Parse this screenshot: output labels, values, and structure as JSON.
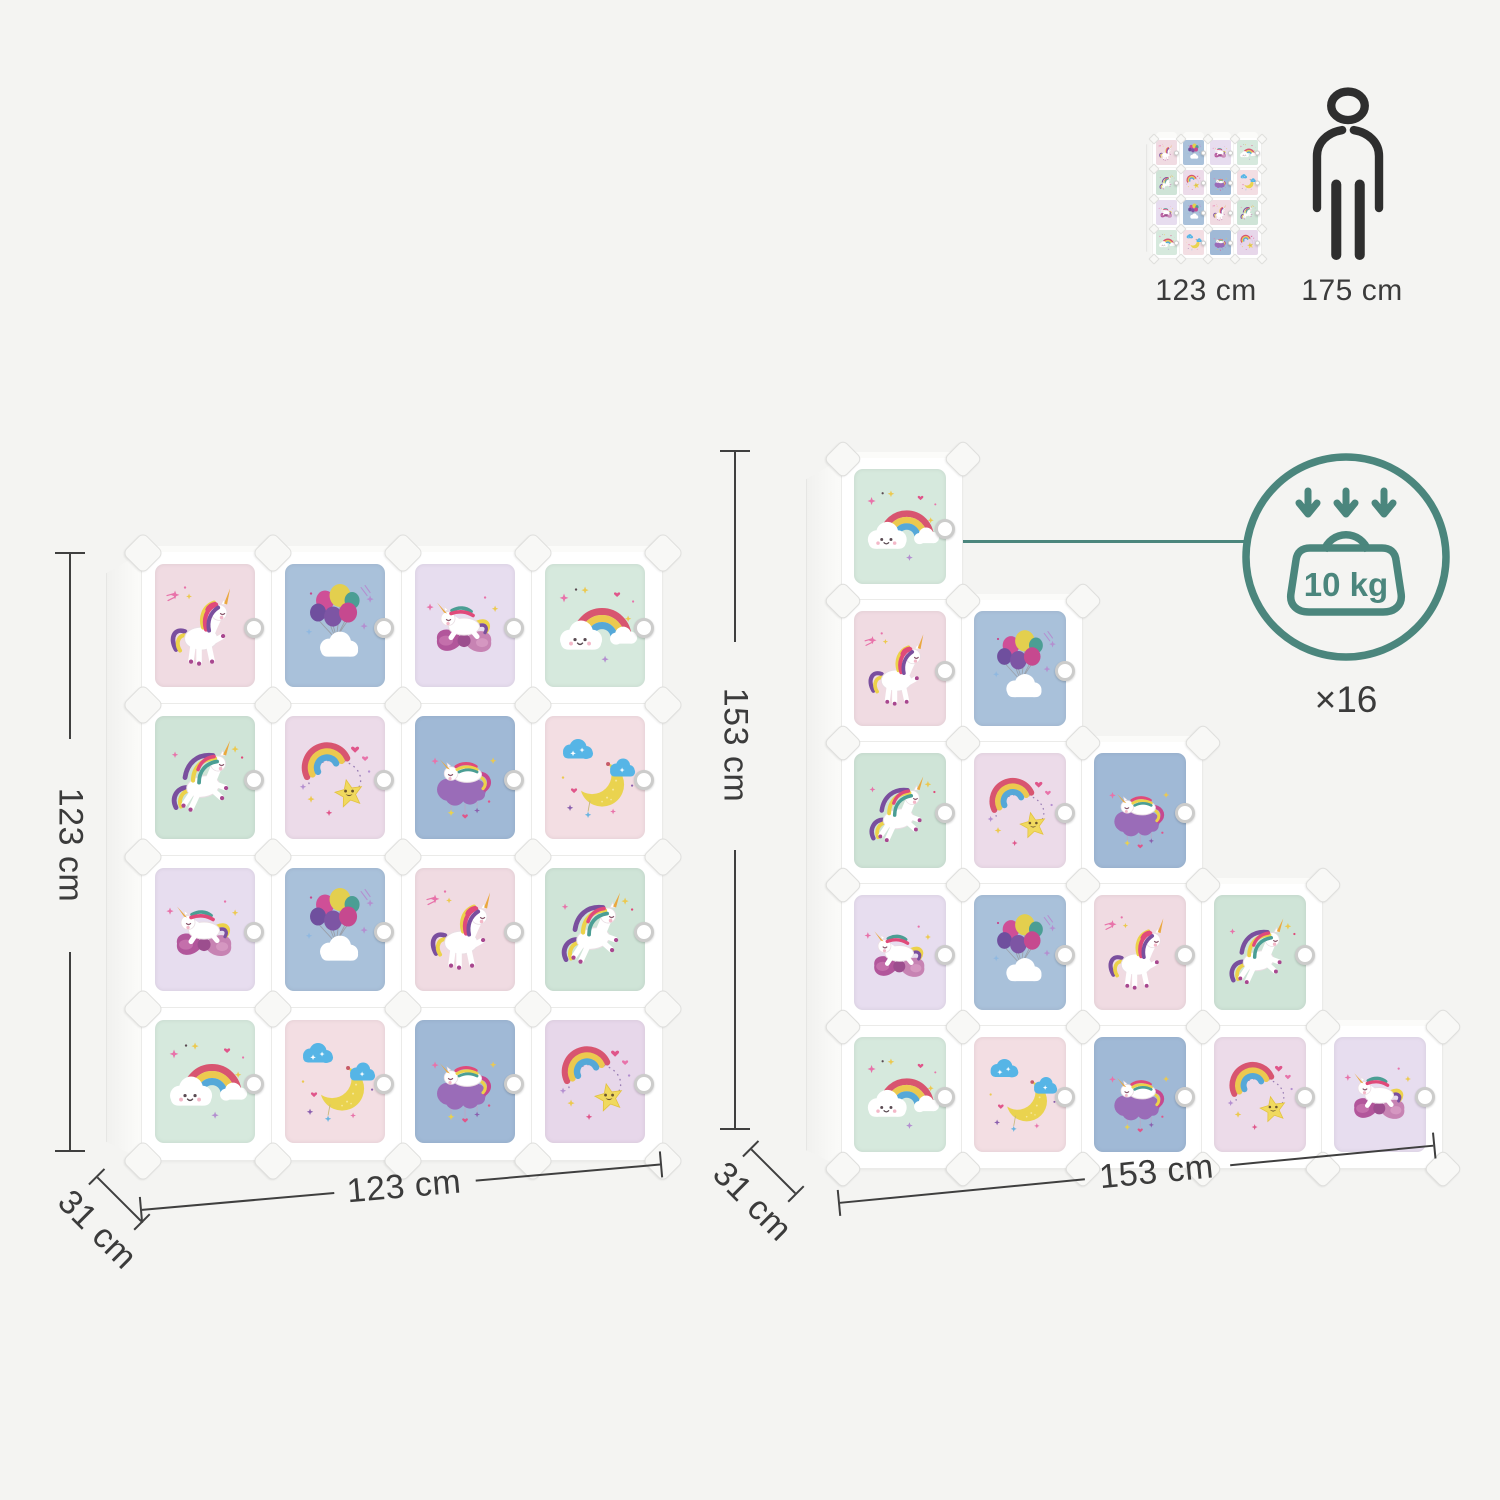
{
  "page": {
    "background": "#f4f4f2"
  },
  "accent": {
    "teal": "#4b867d",
    "label_color": "#3b3b3b",
    "line_color": "#3f3f3f"
  },
  "size_comparison": {
    "mini_organizer_icon": "cube-organizer-icon",
    "organizer_height_label": "123 cm",
    "person_icon": "person-silhouette-icon",
    "person_height_label": "175 cm"
  },
  "load_capacity": {
    "arrows_icon": "triple-down-arrows-icon",
    "weight_icon": "weight-icon",
    "weight_label": "10 kg",
    "per_cube_count_label": "×16"
  },
  "organizers": {
    "square": {
      "height_label": "123 cm",
      "width_label": "123 cm",
      "depth_label": "31 cm",
      "rows": [
        [
          {
            "art": "unicorn-standing",
            "bg": "#f0dbe2"
          },
          {
            "art": "balloons-cloud",
            "bg": "#a9c1da"
          },
          {
            "art": "unicorn-on-bow",
            "bg": "#e7ddef"
          },
          {
            "art": "rainbow-cloud",
            "bg": "#d6e9dd"
          }
        ],
        [
          {
            "art": "unicorn-jumping",
            "bg": "#cfe4d7"
          },
          {
            "art": "rainbow-star",
            "bg": "#ecdbe9"
          },
          {
            "art": "unicorn-sleeping",
            "bg": "#a0b9d6"
          },
          {
            "art": "moon-clouds",
            "bg": "#f3dee3"
          }
        ],
        [
          {
            "art": "unicorn-on-bow",
            "bg": "#e7ddef"
          },
          {
            "art": "balloons-cloud",
            "bg": "#a9c1da"
          },
          {
            "art": "unicorn-standing",
            "bg": "#f0dbe2"
          },
          {
            "art": "unicorn-jumping",
            "bg": "#cfe4d7"
          }
        ],
        [
          {
            "art": "rainbow-cloud",
            "bg": "#d6e9dd"
          },
          {
            "art": "moon-clouds",
            "bg": "#f3dee3"
          },
          {
            "art": "unicorn-sleeping",
            "bg": "#a0b9d6"
          },
          {
            "art": "rainbow-star",
            "bg": "#e7d7ea"
          }
        ]
      ]
    },
    "staircase": {
      "height_label": "153 cm",
      "width_label": "153 cm",
      "depth_label": "31 cm",
      "rows": [
        [
          {
            "art": "rainbow-cloud",
            "bg": "#d6e9dd"
          }
        ],
        [
          {
            "art": "unicorn-standing",
            "bg": "#f0dbe2"
          },
          {
            "art": "balloons-cloud",
            "bg": "#a9c1da"
          }
        ],
        [
          {
            "art": "unicorn-jumping",
            "bg": "#cfe4d7"
          },
          {
            "art": "rainbow-star",
            "bg": "#ecdbe9"
          },
          {
            "art": "unicorn-sleeping",
            "bg": "#a0b9d6"
          }
        ],
        [
          {
            "art": "unicorn-on-bow",
            "bg": "#e7ddef"
          },
          {
            "art": "balloons-cloud",
            "bg": "#a9c1da"
          },
          {
            "art": "unicorn-standing",
            "bg": "#f0dbe2"
          },
          {
            "art": "unicorn-jumping",
            "bg": "#cfe4d7"
          }
        ],
        [
          {
            "art": "rainbow-cloud",
            "bg": "#d6e9dd"
          },
          {
            "art": "moon-clouds",
            "bg": "#f3dee3"
          },
          {
            "art": "unicorn-sleeping",
            "bg": "#a0b9d6"
          },
          {
            "art": "rainbow-star",
            "bg": "#ecdbe9"
          },
          {
            "art": "unicorn-on-bow",
            "bg": "#e7ddef"
          }
        ]
      ]
    }
  }
}
